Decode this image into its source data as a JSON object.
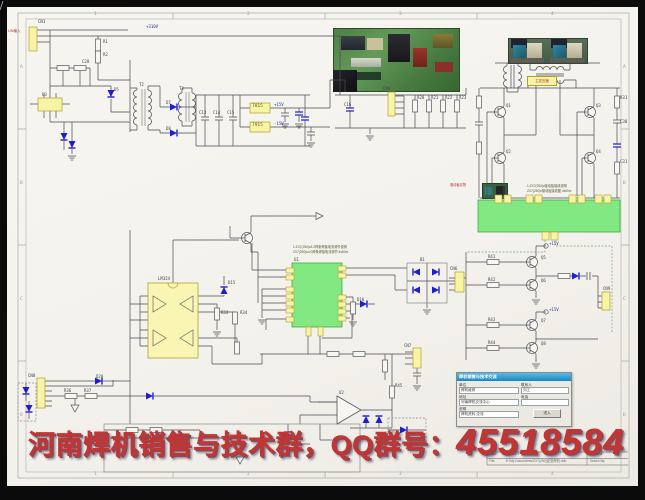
{
  "banner": {
    "group_text": "河南焊机销售与技术群，",
    "qq_label": "QQ群号：",
    "qq_number": "45518584"
  },
  "labels": {
    "input_connector": "L/N输入",
    "transformer_tag": "主变压器",
    "driver_photo_tag": "驱动板实物",
    "pwm_note1": "1.ZX7(250)Ⅱ3.2焊条焊接电流调节说明",
    "pwm_note2": "ZX7(250)Ⅱ4.0焊条焊接电流调节 4x60m",
    "driver_note1": "1.ZX7(250)Ⅱ驱动板接线说明",
    "driver_note2": "ZX7(250)Ⅱ驱动板接线图 4x60m"
  },
  "form": {
    "title": "焊机销售与技术交流",
    "unit_label": "单位",
    "unit_value": "焊机维修",
    "addr_label": "地址",
    "addr_value": "河南焊机交流中心",
    "note_label": "说明",
    "note_value": "焊机资料.交流",
    "contact_label": "联系人",
    "contact_value": "刘工",
    "phone_label": "电话",
    "phone_value": "",
    "button_label": "进入"
  },
  "title_block": {
    "date_label": "Date:",
    "date_value": "2003-3-7",
    "sheet_label": "Sheet of",
    "file_label": "File:",
    "file_value": "E:\\My Documents\\ZX7(250)逆变焊机.ddb",
    "drawn_label": "Drawn By:"
  },
  "colors": {
    "diode_blue": "#1d1dd2",
    "block_yellow": "#f8f4a6",
    "module_green": "#82e882",
    "banner_red": "#c33432",
    "form_tb1": "#55bdea",
    "form_tb2": "#1b84c0",
    "page_bg": "#f4f2ec"
  },
  "designators": [
    {
      "t": "1",
      "x": 94,
      "y": 13,
      "cls": "fr"
    },
    {
      "t": "2",
      "x": 247,
      "y": 13,
      "cls": "fr"
    },
    {
      "t": "3",
      "x": 399,
      "y": 13,
      "cls": "fr"
    },
    {
      "t": "4",
      "x": 551,
      "y": 13,
      "cls": "fr"
    },
    {
      "t": "1",
      "x": 94,
      "y": 472.5,
      "cls": "fr"
    },
    {
      "t": "2",
      "x": 247,
      "y": 472.5,
      "cls": "fr"
    },
    {
      "t": "3",
      "x": 399,
      "y": 472.5,
      "cls": "fr"
    },
    {
      "t": "4",
      "x": 551,
      "y": 472.5,
      "cls": "fr"
    },
    {
      "t": "A",
      "x": 20,
      "y": 66,
      "cls": "fr"
    },
    {
      "t": "B",
      "x": 20,
      "y": 182,
      "cls": "fr"
    },
    {
      "t": "C",
      "x": 20,
      "y": 298,
      "cls": "fr"
    },
    {
      "t": "D",
      "x": 20,
      "y": 414,
      "cls": "fr"
    },
    {
      "t": "A",
      "x": 623,
      "y": 66,
      "cls": "fr"
    },
    {
      "t": "B",
      "x": 623,
      "y": 182,
      "cls": "fr"
    },
    {
      "t": "C",
      "x": 623,
      "y": 298,
      "cls": "fr"
    },
    {
      "t": "D",
      "x": 623,
      "y": 414,
      "cls": "fr"
    },
    {
      "t": "CN1",
      "x": 38,
      "y": 20
    },
    {
      "t": "+310V",
      "x": 146,
      "y": 25,
      "cls": "blue"
    },
    {
      "t": "R1",
      "x": 103,
      "y": 40
    },
    {
      "t": "R2",
      "x": 103,
      "y": 53
    },
    {
      "t": "C28",
      "x": 82,
      "y": 60
    },
    {
      "t": "U3",
      "x": 42,
      "y": 93
    },
    {
      "t": "D5",
      "x": 114,
      "y": 88
    },
    {
      "t": "T2",
      "x": 139,
      "y": 83
    },
    {
      "t": "T3",
      "x": 179,
      "y": 87
    },
    {
      "t": "D7",
      "x": 166,
      "y": 101
    },
    {
      "t": "D8",
      "x": 166,
      "y": 127
    },
    {
      "t": "C13",
      "x": 199,
      "y": 111
    },
    {
      "t": "C14",
      "x": 213,
      "y": 111
    },
    {
      "t": "C15",
      "x": 227,
      "y": 111
    },
    {
      "t": "7815",
      "x": 252,
      "y": 105,
      "cls": "reg"
    },
    {
      "t": "7915",
      "x": 252,
      "y": 124,
      "cls": "reg"
    },
    {
      "t": "+15V",
      "x": 274,
      "y": 103,
      "cls": "blue"
    },
    {
      "t": "-15V",
      "x": 274,
      "y": 122,
      "cls": "blue"
    },
    {
      "t": "CN4",
      "x": 383,
      "y": 87
    },
    {
      "t": "C16",
      "x": 344,
      "y": 103
    },
    {
      "t": "R20",
      "x": 417,
      "y": 96
    },
    {
      "t": "R21",
      "x": 431,
      "y": 96
    },
    {
      "t": "R22",
      "x": 445,
      "y": 96
    },
    {
      "t": "R23",
      "x": 459,
      "y": 96
    },
    {
      "t": "T1",
      "x": 520,
      "y": 57
    },
    {
      "t": "Q1",
      "x": 506,
      "y": 104
    },
    {
      "t": "Q2",
      "x": 506,
      "y": 150
    },
    {
      "t": "Q3",
      "x": 596,
      "y": 104
    },
    {
      "t": "Q4",
      "x": 596,
      "y": 150
    },
    {
      "t": "R31",
      "x": 620,
      "y": 96
    },
    {
      "t": "C30",
      "x": 620,
      "y": 120
    },
    {
      "t": "C31",
      "x": 620,
      "y": 160
    },
    {
      "t": "U1",
      "x": 294,
      "y": 258
    },
    {
      "t": "LM324",
      "x": 158,
      "y": 277
    },
    {
      "t": "D15",
      "x": 228,
      "y": 281
    },
    {
      "t": "D16",
      "x": 357,
      "y": 298
    },
    {
      "t": "B1",
      "x": 420,
      "y": 258
    },
    {
      "t": "CN6",
      "x": 450,
      "y": 267
    },
    {
      "t": "R33",
      "x": 221,
      "y": 311
    },
    {
      "t": "R34",
      "x": 240,
      "y": 311
    },
    {
      "t": "CN8",
      "x": 28,
      "y": 374
    },
    {
      "t": "D20",
      "x": 96,
      "y": 375
    },
    {
      "t": "R36",
      "x": 64,
      "y": 389
    },
    {
      "t": "R37",
      "x": 84,
      "y": 389
    },
    {
      "t": "CN7",
      "x": 404,
      "y": 344
    },
    {
      "t": "U2",
      "x": 339,
      "y": 391
    },
    {
      "t": "R45",
      "x": 395,
      "y": 384
    },
    {
      "t": "+15V",
      "x": 549,
      "y": 242,
      "cls": "blue"
    },
    {
      "t": "+15V",
      "x": 549,
      "y": 308,
      "cls": "blue"
    },
    {
      "t": "Q5",
      "x": 541,
      "y": 256
    },
    {
      "t": "Q6",
      "x": 541,
      "y": 279
    },
    {
      "t": "Q7",
      "x": 541,
      "y": 319
    },
    {
      "t": "Q8",
      "x": 541,
      "y": 342
    },
    {
      "t": "R41",
      "x": 488,
      "y": 255
    },
    {
      "t": "R42",
      "x": 488,
      "y": 278
    },
    {
      "t": "R43",
      "x": 488,
      "y": 318
    },
    {
      "t": "R44",
      "x": 488,
      "y": 341
    },
    {
      "t": "CN9",
      "x": 603,
      "y": 287
    }
  ]
}
